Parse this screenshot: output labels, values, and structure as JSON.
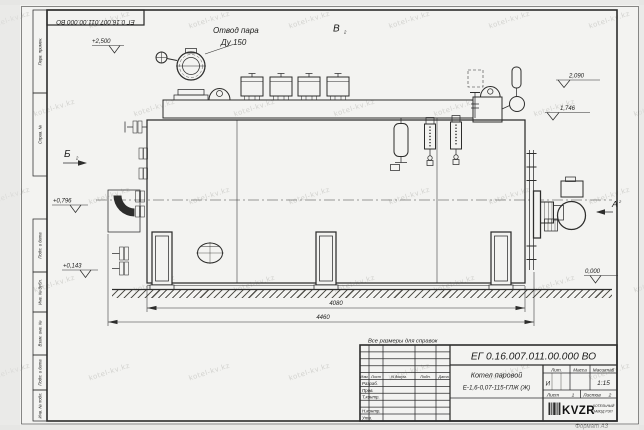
{
  "watermark": {
    "text": "kotel-kv.kz"
  },
  "frame": {
    "columns": {
      "perv_primen": "Перв. примен.",
      "sprav_no": "Справ. №",
      "podp_data1": "Подп. и дата",
      "inv_dubl": "Инв. № дубл.",
      "vzam_inv": "Взам. инв. №",
      "podp_data2": "Подп. и дата",
      "inv_podl": "Инв. № подл."
    },
    "format": "Формат А3"
  },
  "drawing": {
    "note": "Все размеры для справок",
    "steam_outlet": {
      "line1": "Отвод пара",
      "line2": "Ду 150"
    },
    "views": {
      "b": "Б",
      "v": "В",
      "a": "А",
      "sheet_ref": "2"
    },
    "elevations": {
      "steam": "+2,500",
      "top": "2,090",
      "drum": "1,746",
      "mid": "+0,796",
      "low": "+0,143",
      "ground": "0,000"
    },
    "dims": {
      "body_length": "4080",
      "total_length": "4460"
    }
  },
  "title_block": {
    "number": "ЕГ 0.16.007.011.00.000  ВО",
    "product_line1": "Котел паровой",
    "product_line2": "Е-1,6-0,07-115-ГЛЖ (Ж)",
    "lit_header": "Лит.",
    "mass_header": "Масса",
    "scale_header": "Масштаб",
    "lit_value": "И",
    "scale_value": "1:15",
    "sheet_label": "Лист",
    "sheet_value": "1",
    "sheets_label": "Листов",
    "sheets_value": "2",
    "header_cols": [
      "Изм.",
      "Лист",
      "N докум.",
      "Подп.",
      "Дата"
    ],
    "sign_rows": [
      "Разраб.",
      "Пров.",
      "Т.контр.",
      "Н.контр.",
      "Утв."
    ],
    "logo": {
      "name": "KVZR",
      "caption1": "КОТЕЛЬНЫЙ",
      "caption2": "ЗАВОД РЭП"
    }
  }
}
